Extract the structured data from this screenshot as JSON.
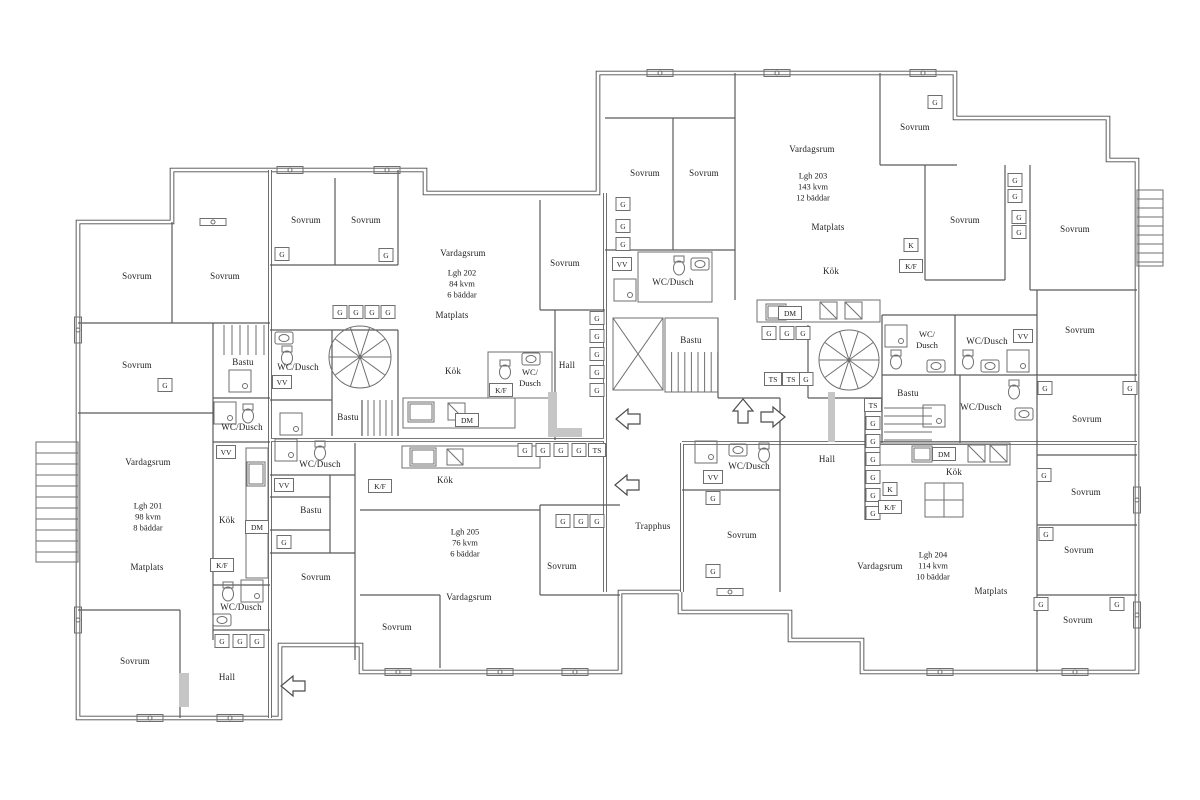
{
  "terms": {
    "sovrum": "Sovrum",
    "vardagsrum": "Vardagsrum",
    "matplats": "Matplats",
    "kok": "Kök",
    "hall": "Hall",
    "bastu": "Bastu",
    "wc_dusch": "WC/Dusch",
    "wc_slash": "WC/",
    "dusch": "Dusch",
    "trapphus": "Trapphus",
    "vv": "VV",
    "dm": "DM",
    "kf": "K/F",
    "k": "K",
    "g": "G",
    "ts": "TS"
  },
  "apartments": [
    {
      "id": "Lgh 201",
      "area": "98 kvm",
      "beds": "8 bäddar"
    },
    {
      "id": "Lgh 202",
      "area": "84 kvm",
      "beds": "6 bäddar"
    },
    {
      "id": "Lgh 203",
      "area": "143 kvm",
      "beds": "12 bäddar"
    },
    {
      "id": "Lgh 204",
      "area": "114 kvm",
      "beds": "10 bäddar"
    },
    {
      "id": "Lgh 205",
      "area": "76 kvm",
      "beds": "6 bäddar"
    }
  ]
}
